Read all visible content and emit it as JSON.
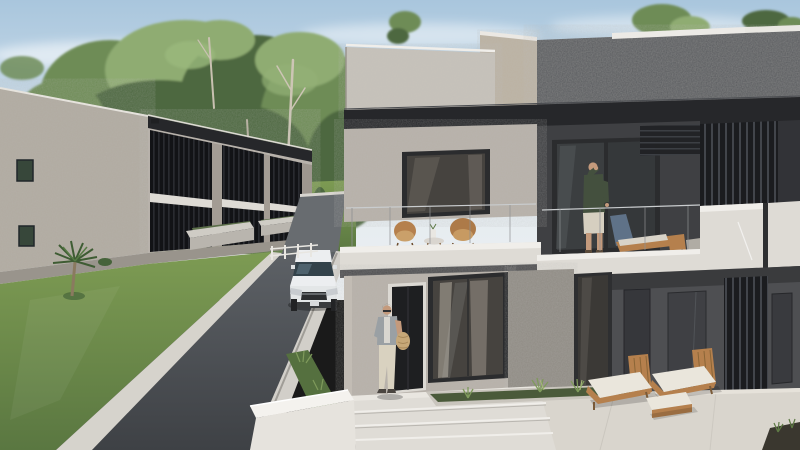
{
  "scene": {
    "type": "architectural-3d-exterior-render",
    "setting": "Daylight rendering of a modern two-storey residential development with balconies, driveway, lawn and landscaped terraces",
    "objects": {
      "sky": "clear blue sky with wispy white clouds",
      "trees": "tall eucalyptus tree line behind the buildings",
      "left_building": "two-storey apartment block with light stucco side wall and black louvred balcony bays",
      "background_garden": "lawn with palm trees and low concrete planters",
      "driveway": "dark asphalt driveway descending toward the viewer",
      "guardrail": "low white guardrail along the driveway edge",
      "car": "white SUV driving down the driveway",
      "front_lawn": "green lawn with a small palm plant",
      "right_building": "modern duplex with charcoal textured upper band, white balcony parapets and glass railings",
      "balcony_left": "upper balcony with two rattan chairs and a round side table with white vase",
      "balcony_right": "upper balcony with a man and a timber sun lounger with blue towel",
      "balcony_man": "man in dark green shirt shading his eyes on the balcony",
      "walking_man": "man with a shoulder scarf and woven bag stepping out of the front door",
      "ground_terrace": "stone paved terrace with two timber loungers, white cushions and an ottoman",
      "planter": "concrete planter strip with ornamental grasses",
      "steps": "white entrance steps and low bright garden walls"
    }
  },
  "palette": {
    "sky-top": "#a9c6dd",
    "sky-mid": "#d9e5ee",
    "sky-horizon": "#eef1f3",
    "tree": "#6e8c57",
    "tree-dark": "#4d683f",
    "tree-light": "#8fac72",
    "wall-side": "#b1aaa0",
    "wall-front": "#b7b1a9",
    "parapet": "#c7c2ba",
    "beige": "#bcb2a2",
    "charcoal": "#56585c",
    "fascia": "#26272a",
    "slab": "#dedbd5",
    "slab-bright": "#f0eeea",
    "lawn-light": "#7d9b53",
    "lawn-dark": "#5a7741",
    "asphalt-light": "#5d6166",
    "asphalt-dark": "#3e4145",
    "curb": "#d6d3cc",
    "glass": "#46433f",
    "frame": "#2b2c2e",
    "darkwall": "#3f4043",
    "gwall": "#4e4f52",
    "pave": "#d9d5cd",
    "bright": "#f4f2ee",
    "wood": "#b5804d",
    "cushion": "#eae6dc",
    "skin": "#c49a7c",
    "shirt-green": "#44503e",
    "shorts": "#d6cfc0",
    "car-body": "#eceef0",
    "car-glass": "#33424a"
  }
}
